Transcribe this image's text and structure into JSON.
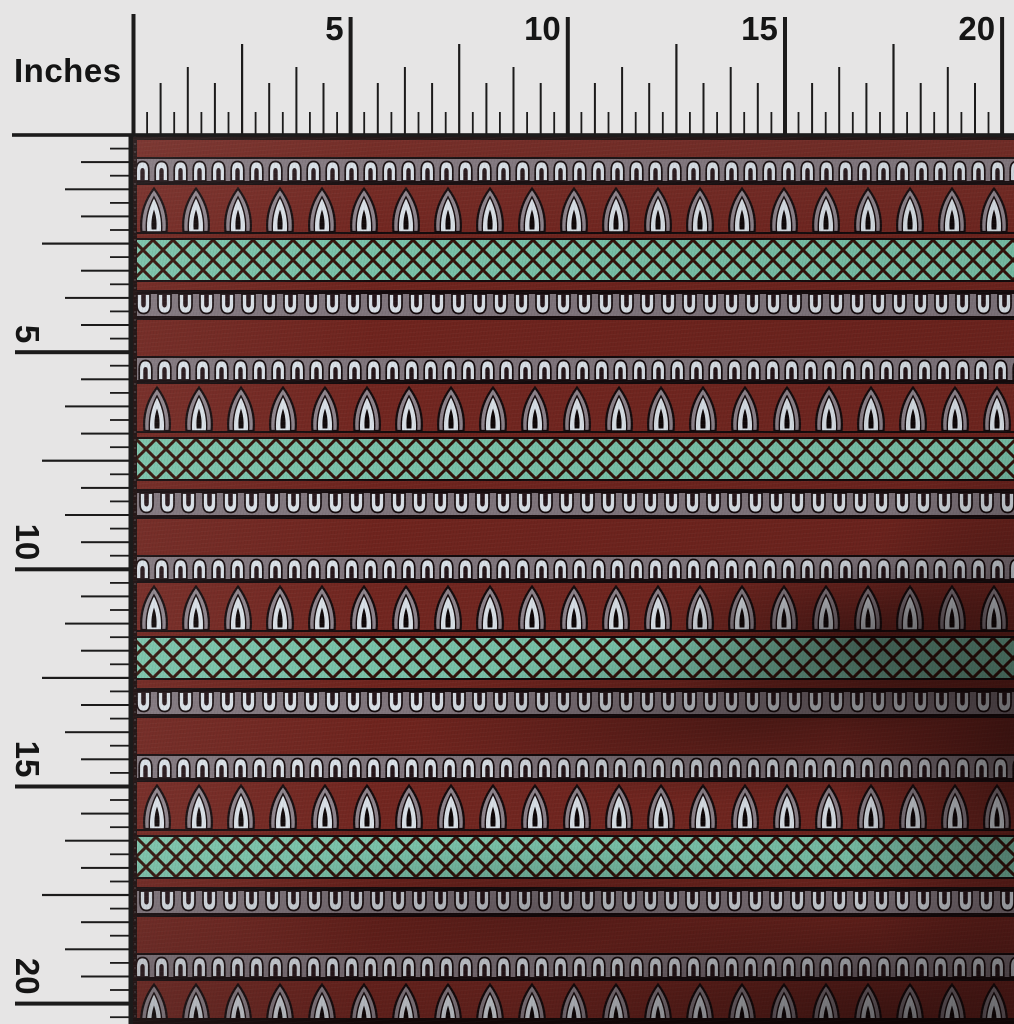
{
  "meta": {
    "description": "Product photo of block-print fabric swatch measured by inch rulers on top and left edges"
  },
  "ruler": {
    "unit_label": "Inches",
    "top_numbers": [
      "5",
      "10",
      "15",
      "20"
    ],
    "left_numbers": [
      "5",
      "10",
      "15",
      "20"
    ],
    "label_step_inches": 5,
    "subdivisions_per_label": 16,
    "px_per_inch": 43.43,
    "origin_x": 133.5,
    "origin_y": 135,
    "tick_color": "#1c1b1b",
    "background_color": "#e6e5e5",
    "tick_lengths": [
      118,
      91,
      68,
      52,
      23
    ],
    "tick_widths": [
      4,
      2.2,
      2,
      2,
      1.8
    ]
  },
  "fabric": {
    "left": 133,
    "top": 135,
    "width": 881,
    "height": 889,
    "base_color": "#6f241e",
    "colors": {
      "maroon": "#6f241e",
      "maroon_bright": "#722620",
      "band_gray": "#80757c",
      "motif_light": "#d9e0e7",
      "motif_gray": "#8d838b",
      "teal": "#79c2a9",
      "lattice_line": "#301109",
      "outline_black": "#140a0c",
      "slot_dark": "#241418",
      "edge_dark": "#1a0c0c",
      "core_black": "#0d0607"
    },
    "repeat_height": 199,
    "first_band_top": 22,
    "top_edge_height": 5,
    "bottom_edge_height": 6,
    "bands": [
      {
        "name": "arch-row",
        "height": 26
      },
      {
        "name": "separator",
        "height": 2
      },
      {
        "name": "teardrop-row",
        "height": 47
      },
      {
        "name": "separator",
        "height": 2
      },
      {
        "name": "maroon-strip",
        "height": 4
      },
      {
        "name": "separator",
        "height": 2
      },
      {
        "name": "trellis-row",
        "height": 40
      },
      {
        "name": "separator",
        "height": 2
      },
      {
        "name": "maroon-strip",
        "height": 8
      },
      {
        "name": "separator",
        "height": 2
      },
      {
        "name": "u-arch-row",
        "height": 26
      },
      {
        "name": "separator",
        "height": 2
      },
      {
        "name": "plain-maroon",
        "height": 36
      }
    ],
    "motifs": {
      "arch_tile_width": 19,
      "u_tile_width": 21,
      "teardrop_tile_width": 42,
      "lattice_cell": 20
    }
  }
}
